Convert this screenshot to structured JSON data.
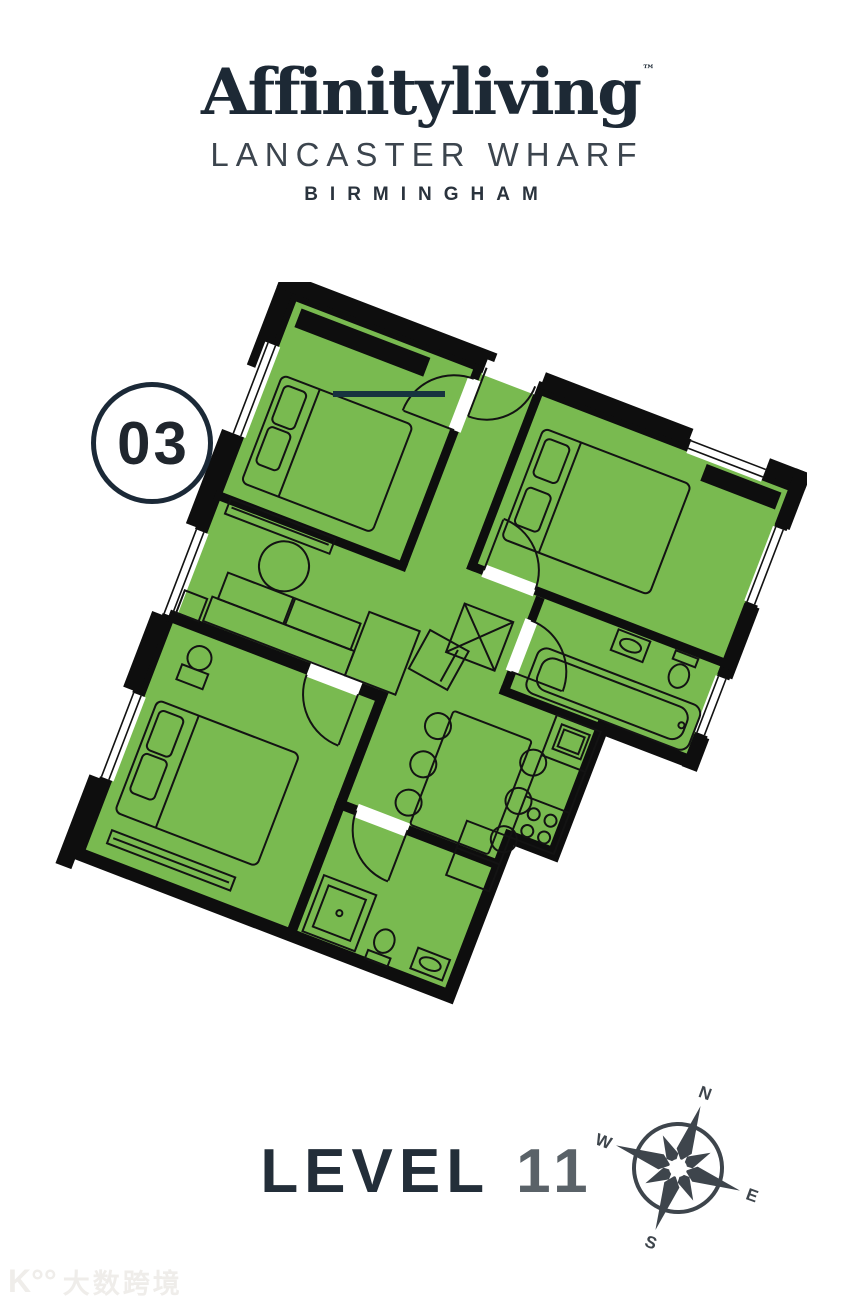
{
  "header": {
    "brand": "Affinityliving",
    "trademark": "™",
    "development": "LANCASTER WHARF",
    "city": "BIRMINGHAM"
  },
  "unit_badge": {
    "number": "03"
  },
  "level_label": {
    "word": "LEVEL",
    "number": "11"
  },
  "compass": {
    "north": "N",
    "east": "E",
    "south": "S",
    "west": "W"
  },
  "watermark": {
    "mark": "K°°",
    "text": "大数跨境"
  },
  "floorplan": {
    "rotation_deg": 21,
    "rooms": [
      "entry-hall",
      "bedroom-1",
      "bedroom-2",
      "bathroom",
      "living-dining",
      "kitchen",
      "bedroom-3",
      "ensuite"
    ],
    "features": [
      "beds",
      "wardrobes",
      "sofa",
      "coffee-table",
      "dining-table-6-chairs",
      "bathtub",
      "shower",
      "toilets",
      "sinks",
      "kitchen-counter-hob"
    ]
  },
  "colors": {
    "brand_navy": "#1D2935",
    "subtitle_gray": "#3C454E",
    "city_navy": "#2A333D",
    "level_navy": "#232E39",
    "level_number_gray": "#5A6268",
    "compass_gray": "#3E454C",
    "badge_navy": "#1B2937",
    "badge_text": "#20262D",
    "watermark_gray": "#EFEDEA",
    "background": "#FFFFFF",
    "floor_green": "#79BA50",
    "wall_black": "#0E0E0E",
    "line_black": "#131313",
    "marker_navy": "#17333F"
  }
}
